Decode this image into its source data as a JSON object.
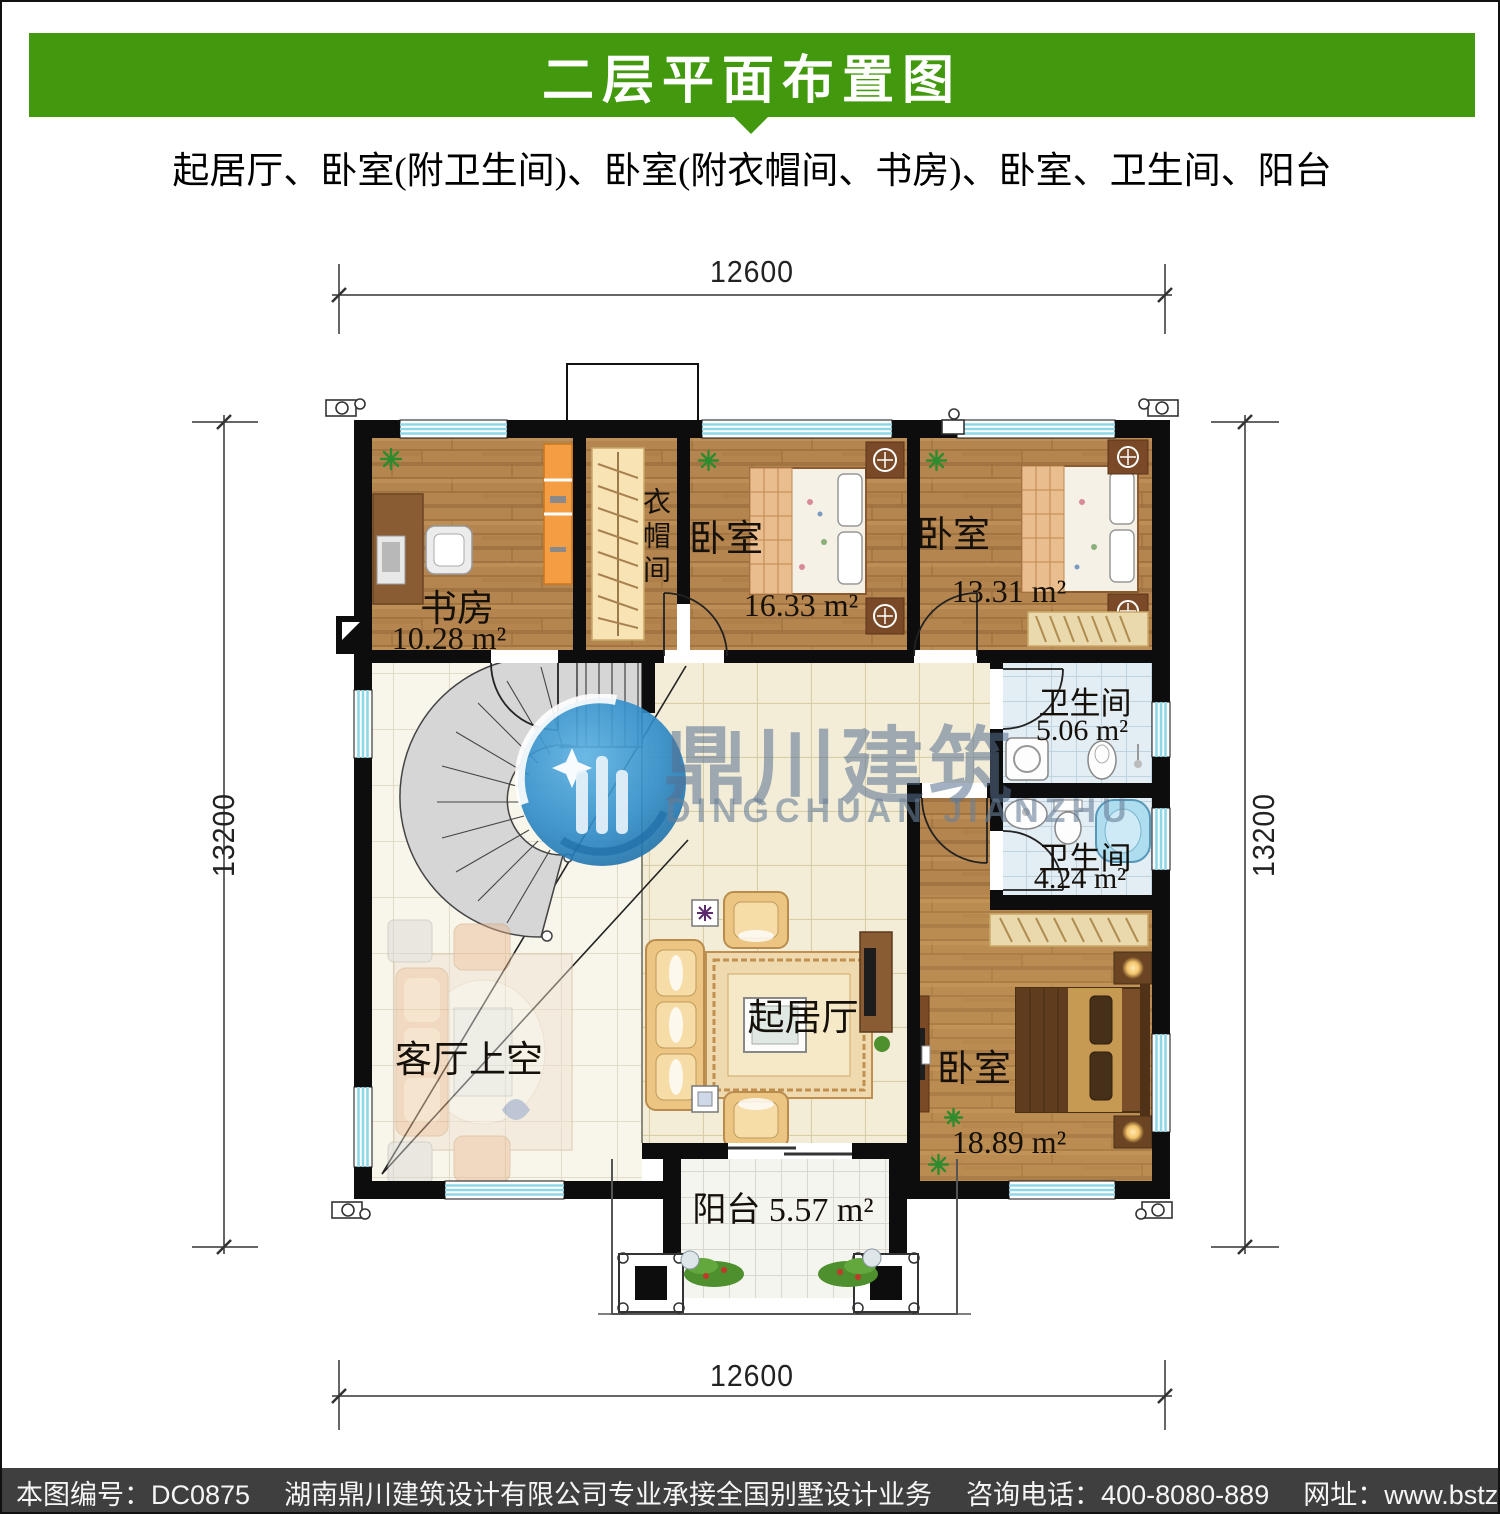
{
  "header": {
    "title": "二层平面布置图",
    "subtitle": "起居厅、卧室(附卫生间)、卧室(附衣帽间、书房)、卧室、卫生间、阳台"
  },
  "dimensions": {
    "top": "12600",
    "bottom": "12600",
    "left": "13200",
    "right": "13200"
  },
  "rooms": {
    "study": {
      "name": "书房",
      "area": "10.28 m²"
    },
    "closet": {
      "name": "衣帽间"
    },
    "bedroom_top_mid": {
      "name": "卧室",
      "area": "16.33 m²"
    },
    "bedroom_top_right": {
      "name": "卧室",
      "area": "13.31 m²"
    },
    "bath_upper": {
      "name": "卫生间",
      "area": "5.06 m²"
    },
    "bath_lower": {
      "name": "卫生间",
      "area": "4.24 m²"
    },
    "living": {
      "name": "起居厅"
    },
    "void": {
      "name": "客厅上空"
    },
    "bedroom_master": {
      "name": "卧室",
      "area": "18.89 m²"
    },
    "balcony": {
      "name": "阳台",
      "area": "5.57 m²"
    }
  },
  "watermark": {
    "logo": "globe-logo",
    "cn": "鼎川建筑",
    "en": "DINGCHUAN JIANZHU"
  },
  "footer": {
    "plan_code": "本图编号：DC0875",
    "company": "湖南鼎川建筑设计有限公司专业承接全国别墅设计业务",
    "phone": "咨询电话：400-8080-889",
    "website": "网址：www.bstzcs.com"
  },
  "colors": {
    "header_green": "#43990d",
    "footer_gray": "#3f3f3f",
    "wall": "#0d0d0d",
    "window_cyan": "#8ed7e6",
    "watermark_blue": "#2e8cc9"
  }
}
